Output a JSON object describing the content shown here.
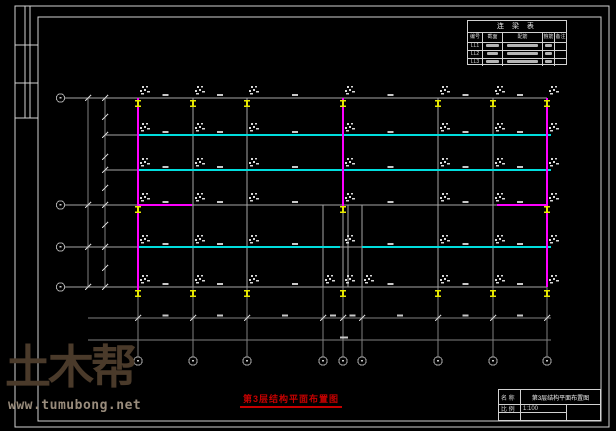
{
  "page": {
    "background": "#000000",
    "frame_color": "#d2d2d2"
  },
  "plan_title": {
    "text": "第3层结构平面布置图",
    "color": "#c40000"
  },
  "schedule_table": {
    "title": "连 梁 表",
    "headers": [
      "编号",
      "截面",
      "配筋",
      "箍筋",
      "备注"
    ],
    "rows": [
      {
        "id": "LL1"
      },
      {
        "id": "LL2"
      },
      {
        "id": "LL3"
      }
    ]
  },
  "title_block": {
    "name_label": "名 称",
    "name_value": "第3层结构平面布置图",
    "scale_label": "比 例",
    "scale_value": "1:100"
  },
  "watermark": {
    "logo": "土木帮",
    "url": "www.tumubong.net",
    "logo_color": "#4a3a2a",
    "url_color": "#998c7c"
  },
  "plan_colors": {
    "grid_line": "#a6a6a6",
    "beam_line_cyan": "#00dede",
    "wall_line_magenta": "#ff00ff",
    "section_marker_yellow": "#e8e800",
    "annotation": "#d9d9d9"
  }
}
